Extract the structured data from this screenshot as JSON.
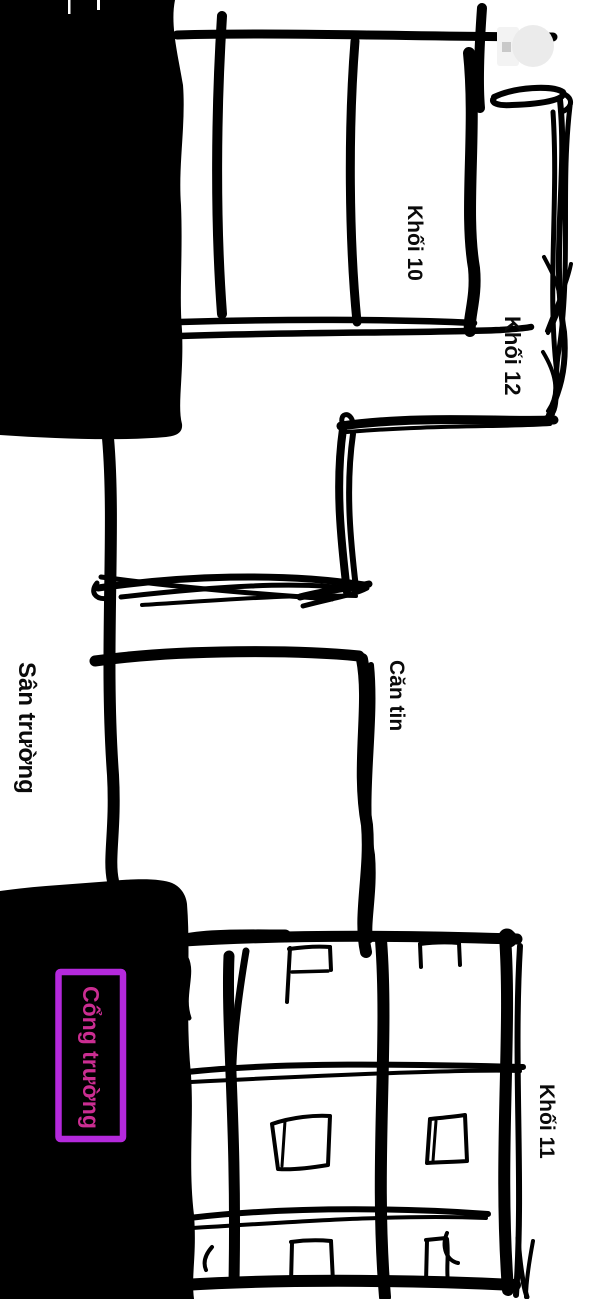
{
  "map": {
    "labels": {
      "khoi10": "Khối 10",
      "khoi12": "Khối 12",
      "cantin": "Căn tin",
      "san_truong": "Sân trường",
      "cong_truong": "Cổng trường",
      "khoi11": "Khối 11"
    },
    "colors": {
      "ink": "#000000",
      "background": "#ffffff",
      "gate_box_border": "#b429dc",
      "gate_box_text": "#cb2d92"
    }
  }
}
